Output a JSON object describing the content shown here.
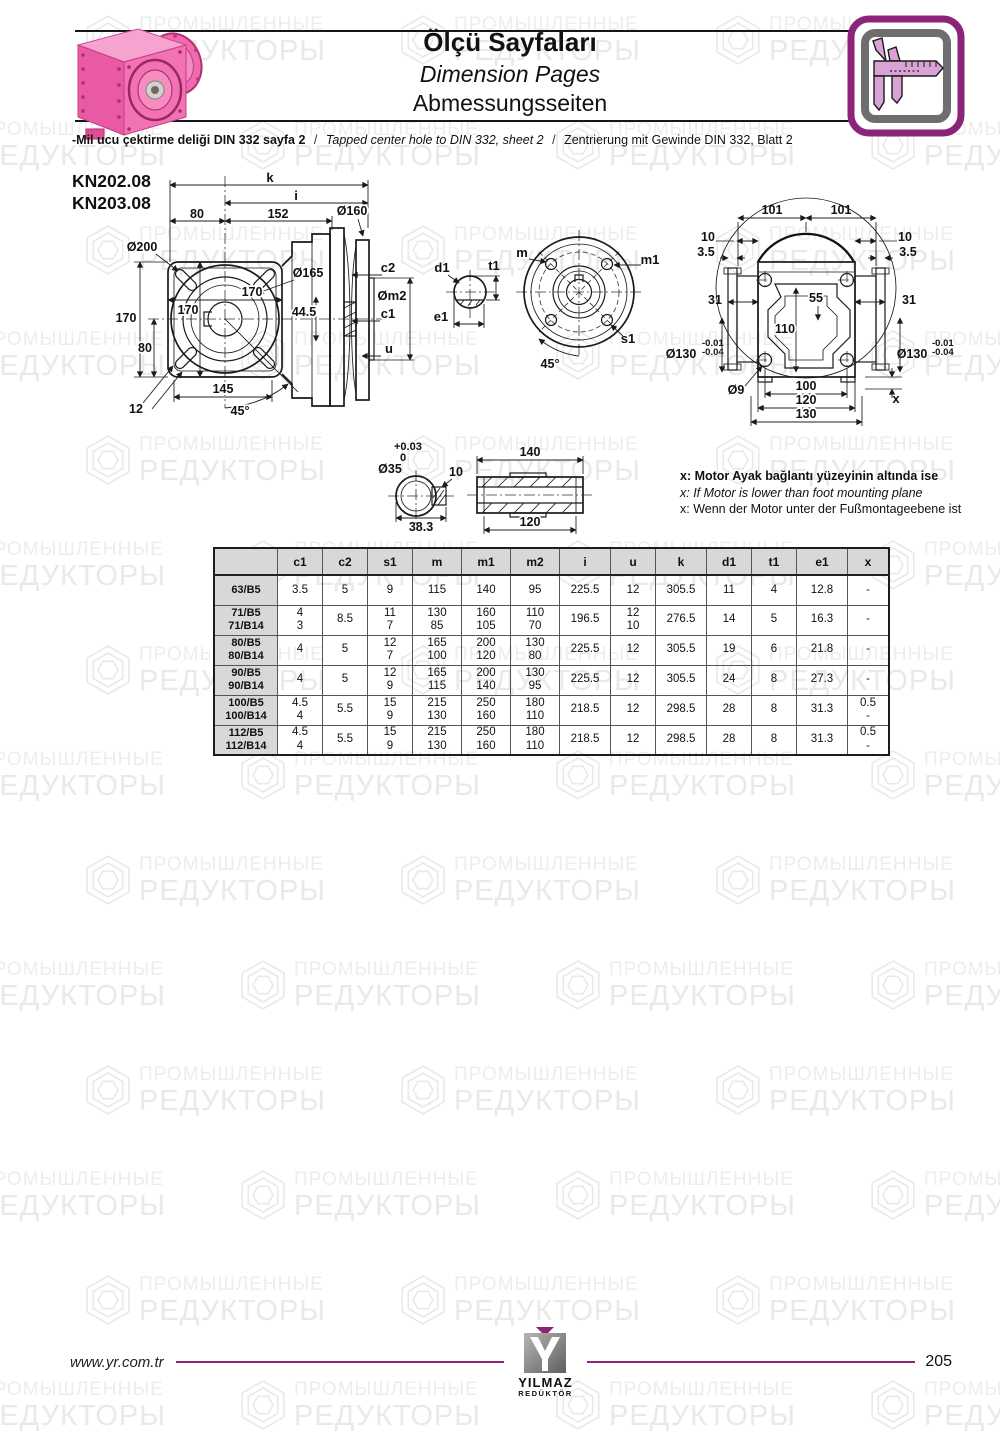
{
  "header": {
    "title_tr": "Ölçü Sayfaları",
    "title_en": "Dimension Pages",
    "title_de": "Abmessungsseiten"
  },
  "note": {
    "tr": "-Mil ucu çektirme deliği DIN 332 sayfa 2",
    "sep": "/",
    "en": "Tapped center hole to DIN 332, sheet 2",
    "de": "Zentrierung mit Gewinde DIN 332, Blatt 2"
  },
  "models": {
    "m1": "KN202.08",
    "m2": "KN203.08"
  },
  "dims": {
    "front": {
      "k": "k",
      "i": "i",
      "w80": "80",
      "w152": "152",
      "d160": "Ø160",
      "d200": "Ø200",
      "d165": "Ø165",
      "w170": "170",
      "h170in": "170",
      "h170out": "170",
      "h80": "80",
      "v445": "44.5",
      "b145": "145",
      "b12": "12",
      "a45": "45°",
      "c2": "c2",
      "m2": "Øm2",
      "c1": "c1",
      "u": "u"
    },
    "flange": {
      "d1": "d1",
      "t1": "t1",
      "e1": "e1",
      "m": "m",
      "m1": "m1",
      "s1": "s1",
      "a45": "45°"
    },
    "rear": {
      "w101l": "101",
      "w101r": "101",
      "t10l": "10",
      "t35l": "3.5",
      "t10r": "10",
      "t35r": "3.5",
      "s31l": "31",
      "s31r": "31",
      "s55": "55",
      "s110": "110",
      "d130l": "Ø130",
      "d130r": "Ø130",
      "tol1": "-0.01",
      "tol2": "-0.04",
      "d9": "Ø9",
      "b100": "100",
      "b120": "120",
      "b130": "130",
      "x": "x"
    },
    "shaft": {
      "tolp": "+0.03",
      "tol0": "0",
      "d35": "Ø35",
      "k10": "10",
      "w383": "38.3",
      "l140": "140",
      "l120": "120"
    }
  },
  "motor_note": {
    "tr": "x: Motor Ayak bağlantı yüzeyinin altında ise",
    "en": "x: If Motor is lower than foot mounting plane",
    "de": "x: Wenn der Motor unter der Fußmontageebene ist"
  },
  "table": {
    "corner": "",
    "headers": [
      "c1",
      "c2",
      "s1",
      "m",
      "m1",
      "m2",
      "i",
      "u",
      "k",
      "d1",
      "t1",
      "e1",
      "x"
    ],
    "rows": [
      {
        "label": [
          "63/B5"
        ],
        "cells": [
          [
            "3.5"
          ],
          [
            "5"
          ],
          [
            "9"
          ],
          [
            "115"
          ],
          [
            "140"
          ],
          [
            "95"
          ],
          [
            "225.5"
          ],
          [
            "12"
          ],
          [
            "305.5"
          ],
          [
            "11"
          ],
          [
            "4"
          ],
          [
            "12.8"
          ],
          [
            "-"
          ]
        ]
      },
      {
        "label": [
          "71/B5",
          "71/B14"
        ],
        "cells": [
          [
            "4",
            "3"
          ],
          [
            "8.5"
          ],
          [
            "11",
            "7"
          ],
          [
            "130",
            "85"
          ],
          [
            "160",
            "105"
          ],
          [
            "110",
            "70"
          ],
          [
            "196.5"
          ],
          [
            "12",
            "10"
          ],
          [
            "276.5"
          ],
          [
            "14"
          ],
          [
            "5"
          ],
          [
            "16.3"
          ],
          [
            "-"
          ]
        ]
      },
      {
        "label": [
          "80/B5",
          "80/B14"
        ],
        "cells": [
          [
            "4"
          ],
          [
            "5"
          ],
          [
            "12",
            "7"
          ],
          [
            "165",
            "100"
          ],
          [
            "200",
            "120"
          ],
          [
            "130",
            "80"
          ],
          [
            "225.5"
          ],
          [
            "12"
          ],
          [
            "305.5"
          ],
          [
            "19"
          ],
          [
            "6"
          ],
          [
            "21.8"
          ],
          [
            "-"
          ]
        ]
      },
      {
        "label": [
          "90/B5",
          "90/B14"
        ],
        "cells": [
          [
            "4"
          ],
          [
            "5"
          ],
          [
            "12",
            "9"
          ],
          [
            "165",
            "115"
          ],
          [
            "200",
            "140"
          ],
          [
            "130",
            "95"
          ],
          [
            "225.5"
          ],
          [
            "12"
          ],
          [
            "305.5"
          ],
          [
            "24"
          ],
          [
            "8"
          ],
          [
            "27.3"
          ],
          [
            "-"
          ]
        ]
      },
      {
        "label": [
          "100/B5",
          "100/B14"
        ],
        "cells": [
          [
            "4.5",
            "4"
          ],
          [
            "5.5"
          ],
          [
            "15",
            "9"
          ],
          [
            "215",
            "130"
          ],
          [
            "250",
            "160"
          ],
          [
            "180",
            "110"
          ],
          [
            "218.5"
          ],
          [
            "12"
          ],
          [
            "298.5"
          ],
          [
            "28"
          ],
          [
            "8"
          ],
          [
            "31.3"
          ],
          [
            "0.5",
            "-"
          ]
        ]
      },
      {
        "label": [
          "112/B5",
          "112/B14"
        ],
        "cells": [
          [
            "4.5",
            "4"
          ],
          [
            "5.5"
          ],
          [
            "15",
            "9"
          ],
          [
            "215",
            "130"
          ],
          [
            "250",
            "160"
          ],
          [
            "180",
            "110"
          ],
          [
            "218.5"
          ],
          [
            "12"
          ],
          [
            "298.5"
          ],
          [
            "28"
          ],
          [
            "8"
          ],
          [
            "31.3"
          ],
          [
            "0.5",
            "-"
          ]
        ]
      }
    ]
  },
  "footer": {
    "website": "www.yr.com.tr",
    "logo_name": "YILMAZ",
    "logo_sub": "REDÜKTÖR",
    "page": "205"
  },
  "watermark": {
    "line1": "ПРОМЫШЛЕННЫЕ",
    "line2": "РЕДУКТОРЫ"
  },
  "colors": {
    "accent": "#8b2478",
    "pink": "#ec5fa6",
    "table_header_bg": "#d8d8d8"
  }
}
